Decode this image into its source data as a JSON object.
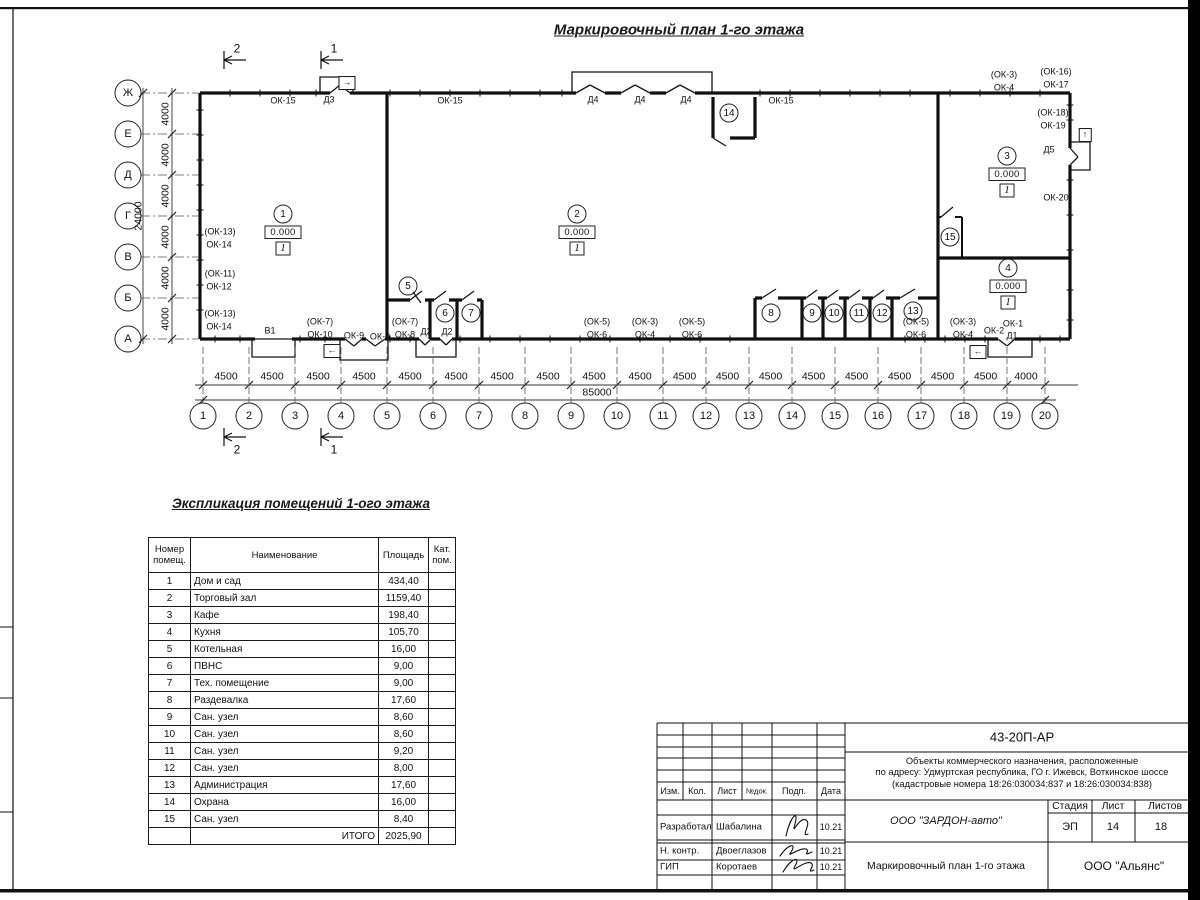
{
  "title": "Маркировочный план 1-го этажа",
  "plan": {
    "axes_bottom": {
      "y": 416,
      "labels": [
        "1",
        "2",
        "3",
        "4",
        "5",
        "6",
        "7",
        "8",
        "9",
        "10",
        "11",
        "12",
        "13",
        "14",
        "15",
        "16",
        "17",
        "18",
        "19",
        "20"
      ],
      "xs": [
        203,
        249,
        295,
        341,
        387,
        433,
        479,
        525,
        571,
        617,
        663,
        706,
        749,
        792,
        835,
        878,
        921,
        964,
        1007,
        1045
      ]
    },
    "axes_left": {
      "x": 128,
      "labels": [
        "Ж",
        "Е",
        "Д",
        "Г",
        "В",
        "Б",
        "А"
      ],
      "ys": [
        93,
        134,
        175,
        216,
        257,
        298,
        339
      ]
    },
    "dims_bottom": {
      "y": 377,
      "values": [
        "4500",
        "4500",
        "4500",
        "4500",
        "4500",
        "4500",
        "4500",
        "4500",
        "4500",
        "4500",
        "4500",
        "4500",
        "4500",
        "4500",
        "4500",
        "4500",
        "4500",
        "4500",
        "4000"
      ]
    },
    "dim_bottom_total": {
      "text": "85000",
      "x": 597,
      "y": 393
    },
    "dims_left": {
      "x": 166,
      "values": [
        "4000",
        "4000",
        "4000",
        "4000",
        "4000",
        "4000"
      ]
    },
    "dim_left_total": {
      "text": "24000",
      "x": 139,
      "y": 216
    },
    "sections": [
      {
        "n": "2",
        "x": 237,
        "y": 49
      },
      {
        "n": "1",
        "x": 334,
        "y": 49
      },
      {
        "n": "2",
        "x": 237,
        "y": 450
      },
      {
        "n": "1",
        "x": 334,
        "y": 450
      }
    ],
    "rooms": [
      {
        "n": "1",
        "x": 283,
        "y": 214,
        "elev": "0.000",
        "floor": "1"
      },
      {
        "n": "2",
        "x": 577,
        "y": 214,
        "elev": "0.000",
        "floor": "1"
      },
      {
        "n": "3",
        "x": 1007,
        "y": 156,
        "elev": "0.000",
        "floor": "1"
      },
      {
        "n": "4",
        "x": 1008,
        "y": 268,
        "elev": "0.000",
        "floor": "1"
      },
      {
        "n": "5",
        "x": 408,
        "y": 286
      },
      {
        "n": "6",
        "x": 445,
        "y": 313
      },
      {
        "n": "7",
        "x": 471,
        "y": 313
      },
      {
        "n": "8",
        "x": 771,
        "y": 313
      },
      {
        "n": "9",
        "x": 812,
        "y": 313
      },
      {
        "n": "10",
        "x": 834,
        "y": 313
      },
      {
        "n": "11",
        "x": 859,
        "y": 313
      },
      {
        "n": "12",
        "x": 882,
        "y": 313
      },
      {
        "n": "13",
        "x": 913,
        "y": 311
      },
      {
        "n": "14",
        "x": 729,
        "y": 113
      },
      {
        "n": "15",
        "x": 950,
        "y": 237
      }
    ],
    "marks": [
      {
        "t": "ОК-15",
        "x": 283,
        "y": 101
      },
      {
        "t": "Д3",
        "x": 329,
        "y": 100
      },
      {
        "t": "ОК-15",
        "x": 450,
        "y": 101
      },
      {
        "t": "Д4",
        "x": 593,
        "y": 100
      },
      {
        "t": "Д4",
        "x": 640,
        "y": 100
      },
      {
        "t": "Д4",
        "x": 686,
        "y": 100
      },
      {
        "t": "ОК-15",
        "x": 781,
        "y": 101
      },
      {
        "t": "(ОК-3)",
        "x": 1004,
        "y": 75
      },
      {
        "t": "ОК-4",
        "x": 1004,
        "y": 88
      },
      {
        "t": "(ОК-16)",
        "x": 1056,
        "y": 72
      },
      {
        "t": "ОК-17",
        "x": 1056,
        "y": 85
      },
      {
        "t": "(ОК-18)",
        "x": 1053,
        "y": 113
      },
      {
        "t": "ОК-19",
        "x": 1053,
        "y": 126
      },
      {
        "t": "Д5",
        "x": 1049,
        "y": 150
      },
      {
        "t": "ОК-20",
        "x": 1056,
        "y": 198
      },
      {
        "t": "(ОК-13)",
        "x": 220,
        "y": 232
      },
      {
        "t": "ОК-14",
        "x": 219,
        "y": 245
      },
      {
        "t": "(ОК-11)",
        "x": 220,
        "y": 274
      },
      {
        "t": "ОК-12",
        "x": 219,
        "y": 287
      },
      {
        "t": "(ОК-13)",
        "x": 220,
        "y": 314
      },
      {
        "t": "ОК-14",
        "x": 219,
        "y": 327
      },
      {
        "t": "В1",
        "x": 270,
        "y": 331
      },
      {
        "t": "(ОК-7)",
        "x": 320,
        "y": 322
      },
      {
        "t": "ОК-10",
        "x": 320,
        "y": 335
      },
      {
        "t": "ОК-9",
        "x": 354,
        "y": 336
      },
      {
        "t": "ОК-9",
        "x": 380,
        "y": 337
      },
      {
        "t": "(ОК-7)",
        "x": 405,
        "y": 322
      },
      {
        "t": "ОК-8",
        "x": 405,
        "y": 335
      },
      {
        "t": "Д2",
        "x": 426,
        "y": 332
      },
      {
        "t": "Д2",
        "x": 447,
        "y": 332
      },
      {
        "t": "(ОК-5)",
        "x": 597,
        "y": 322
      },
      {
        "t": "ОК-6",
        "x": 597,
        "y": 335
      },
      {
        "t": "(ОК-3)",
        "x": 645,
        "y": 322
      },
      {
        "t": "ОК-4",
        "x": 645,
        "y": 335
      },
      {
        "t": "(ОК-5)",
        "x": 692,
        "y": 322
      },
      {
        "t": "ОК-6",
        "x": 692,
        "y": 335
      },
      {
        "t": "(ОК-5)",
        "x": 916,
        "y": 322
      },
      {
        "t": "ОК-6",
        "x": 916,
        "y": 335
      },
      {
        "t": "(ОК-3)",
        "x": 963,
        "y": 322
      },
      {
        "t": "ОК-4",
        "x": 963,
        "y": 335
      },
      {
        "t": "ОК-2",
        "x": 994,
        "y": 331
      },
      {
        "t": "ОК-1",
        "x": 1013,
        "y": 324
      },
      {
        "t": "Д1",
        "x": 1012,
        "y": 336
      }
    ],
    "exit_arrows": [
      {
        "t": "→",
        "x": 347,
        "y": 83
      },
      {
        "t": "↑",
        "x": 1085,
        "y": 135
      },
      {
        "t": "←",
        "x": 332,
        "y": 351
      },
      {
        "t": "←",
        "x": 978,
        "y": 352
      }
    ]
  },
  "explication": {
    "title": "Экспликация помещений 1-ого этажа",
    "col_num": "Номер помещ.",
    "col_name": "Наименование",
    "col_area": "Площадь",
    "col_cat": "Кат. пом.",
    "rows": [
      [
        "1",
        "Дом и сад",
        "434,40"
      ],
      [
        "2",
        "Торговый зал",
        "1159,40"
      ],
      [
        "3",
        "Кафе",
        "198,40"
      ],
      [
        "4",
        "Кухня",
        "105,70"
      ],
      [
        "5",
        "Котельная",
        "16,00"
      ],
      [
        "6",
        "ПВНС",
        "9,00"
      ],
      [
        "7",
        "Тех. помещение",
        "9,00"
      ],
      [
        "8",
        "Раздевалка",
        "17,60"
      ],
      [
        "9",
        "Сан. узел",
        "8,60"
      ],
      [
        "10",
        "Сан. узел",
        "8,60"
      ],
      [
        "11",
        "Сан. узел",
        "9,20"
      ],
      [
        "12",
        "Сан. узел",
        "8,00"
      ],
      [
        "13",
        "Администрация",
        "17,60"
      ],
      [
        "14",
        "Охрана",
        "16,00"
      ],
      [
        "15",
        "Сан. узел",
        "8,40"
      ]
    ],
    "total_label": "ИТОГО",
    "total_value": "2025,90"
  },
  "title_block": {
    "doc_number": "43-20П-АР",
    "description_lines": [
      "Объекты коммерческого назначения, расположенные",
      "по адресу: Удмуртская республика, ГО г. Ижевск, Воткинское шоссе",
      "(кадастровые номера 18:26:030034:837 и 18:26:030034:838)"
    ],
    "cols": [
      "Изм.",
      "Кол.",
      "Лист",
      "№док.",
      "Подп.",
      "Дата"
    ],
    "people": [
      {
        "role": "Разработал",
        "name": "Шабалина",
        "date": "10.21"
      },
      {
        "role": "Н. контр.",
        "name": "Двоеглазов",
        "date": "10.21"
      },
      {
        "role": "ГИП",
        "name": "Коротаев",
        "date": "10.21"
      }
    ],
    "company": "ООО \"ЗАРДОН-авто\"",
    "sheet_title": "Маркировочный план 1-го этажа",
    "firm": "ООО \"Альянс\"",
    "stage_label": "Стадия",
    "sheet_label": "Лист",
    "sheets_label": "Листов",
    "stage": "ЭП",
    "sheet": "14",
    "sheets": "18"
  }
}
